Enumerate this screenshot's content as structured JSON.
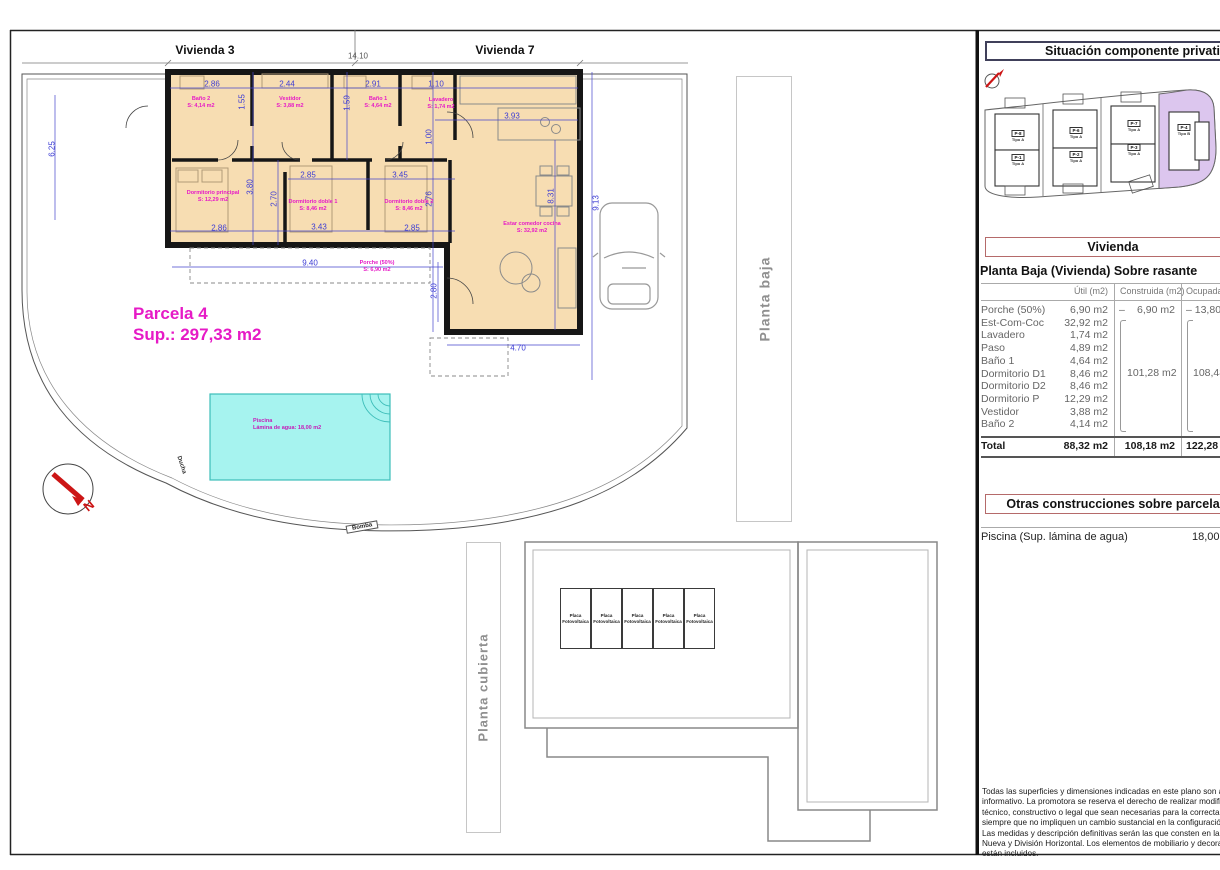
{
  "plan": {
    "vivienda3": "Vivienda 3",
    "vivienda7": "Vivienda 7",
    "top_dim": "14.10",
    "parcela": {
      "line1": "Parcela 4",
      "line2": "Sup.: 297,33 m2"
    },
    "pool": {
      "line1": "Piscina",
      "line2": "Lámina de agua: 18,00 m2"
    },
    "compass_n": "N",
    "ducha": "Ducha",
    "bomba": "Bomba",
    "planta_baja": "Planta baja",
    "planta_cubierta": "Planta cubierta",
    "solar": {
      "line1": "Placa",
      "line2": "Fotovoltaica"
    },
    "rooms": [
      {
        "name": "Baño 2",
        "area": "S: 4,14 m2"
      },
      {
        "name": "Vestidor",
        "area": "S: 3,88 m2"
      },
      {
        "name": "Baño 1",
        "area": "S: 4,64 m2"
      },
      {
        "name": "Lavadero",
        "area": "S: 1,74 m2"
      },
      {
        "name": "Dormitorio principal",
        "area": "S: 12,29 m2"
      },
      {
        "name": "Dormitorio doble 1",
        "area": "S: 8,46 m2"
      },
      {
        "name": "Dormitorio doble 2",
        "area": "S: 8,46 m2"
      },
      {
        "name": "Estar comedor cocina",
        "area": "S: 32,92 m2"
      },
      {
        "name": "Porche (50%)",
        "area": "S: 6,90 m2"
      }
    ],
    "dims": [
      "2.86",
      "2.44",
      "2.91",
      "1.10",
      "3.93",
      "1.55",
      "1.59",
      "1.00",
      "2.85",
      "3.45",
      "3.80",
      "2.70",
      "2.76",
      "2.86",
      "3.43",
      "2.85",
      "8.31",
      "9.13",
      "6.25",
      "9.40",
      "2.80",
      "4.70"
    ]
  },
  "panel": {
    "situacion_title": "Situación componente privativo",
    "plots": [
      {
        "id": "P-8",
        "tipo": "Tipo A"
      },
      {
        "id": "P-1",
        "tipo": "Tipo A"
      },
      {
        "id": "P-6",
        "tipo": "Tipo A"
      },
      {
        "id": "P-2",
        "tipo": "Tipo A"
      },
      {
        "id": "P-7",
        "tipo": "Tipo A"
      },
      {
        "id": "P-3",
        "tipo": "Tipo A"
      },
      {
        "id": "P-4",
        "tipo": "Tipo B"
      }
    ],
    "vivienda_title": "Vivienda",
    "table": {
      "title": "Planta Baja (Vivienda) Sobre rasante",
      "col_util": "Útil (m2)",
      "col_construida": "Construida (m2)",
      "col_ocupada": "Ocupada",
      "rows": [
        {
          "label": "Porche (50%)",
          "util": "6,90 m2"
        },
        {
          "label": "Est-Com-Coc",
          "util": "32,92 m2"
        },
        {
          "label": "Lavadero",
          "util": "1,74 m2"
        },
        {
          "label": "Paso",
          "util": "4,89 m2"
        },
        {
          "label": "Baño 1",
          "util": "4,64 m2"
        },
        {
          "label": "Dormitorio D1",
          "util": "8,46 m2"
        },
        {
          "label": "Dormitorio D2",
          "util": "8,46 m2"
        },
        {
          "label": "Dormitorio P",
          "util": "12,29 m2"
        },
        {
          "label": "Vestidor",
          "util": "3,88 m2"
        },
        {
          "label": "Baño 2",
          "util": "4,14 m2"
        }
      ],
      "porche_construida_dash": "–",
      "porche_construida": "6,90 m2",
      "porche_ocupada": "–  13,80",
      "group_construida": "101,28 m2",
      "group_ocupada": "108,48",
      "total_label": "Total",
      "total_util": "88,32 m2",
      "total_construida": "108,18 m2",
      "total_ocupada": "122,28"
    },
    "otras_title": "Otras construcciones sobre parcela",
    "piscina_label": "Piscina (Sup. lámina de agua)",
    "piscina_value": "18,00",
    "disclaimer_lines": [
      "Todas las superficies y dimensiones indicadas en este plano son a título me",
      "informativo. La promotora se reserva el derecho de realizar modificaciones de",
      "técnico, constructivo o legal que sean necesarias para la correcta ejecución del",
      "siempre que no impliquen un cambio sustancial en la configuración o calidad de la",
      "Las medidas y descripción definitivas serán las que consten en la Escritura Públic",
      "Nueva y División Horizontal. Los elementos de mobiliario y decoración son ilustrati",
      "están incluidos."
    ]
  }
}
